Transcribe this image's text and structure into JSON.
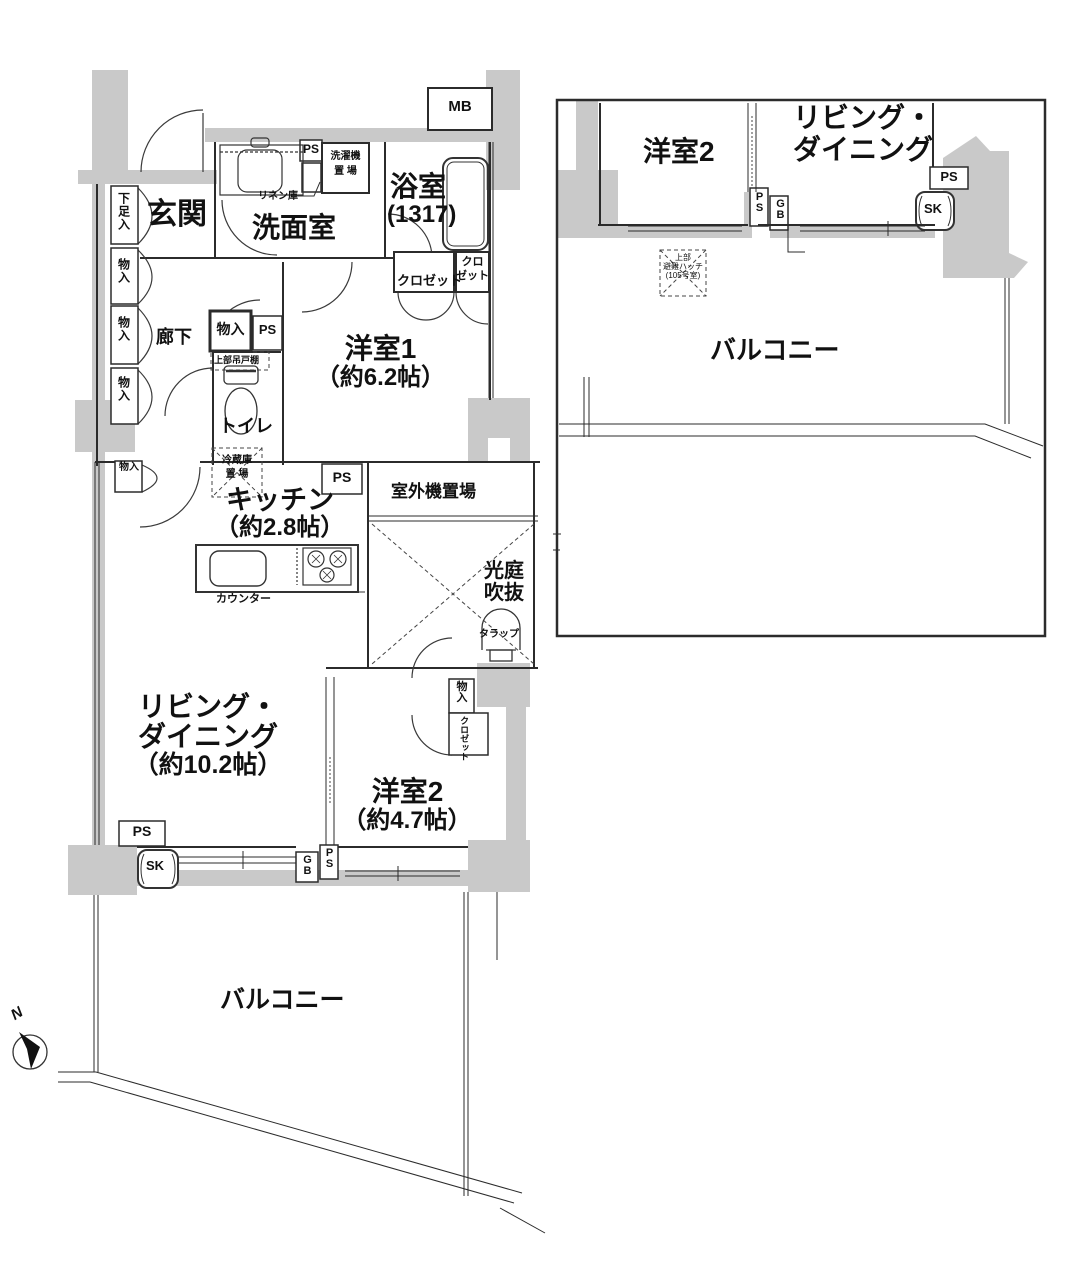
{
  "labels": {
    "genkan": "玄関",
    "rouka": "廊下",
    "senmen": "洗面室",
    "yokushitsu": "浴室",
    "yokushitsu_size": "(1317)",
    "yoshitsu1": "洋室1",
    "yoshitsu1_size": "（約6.2帖）",
    "kitchen": "キッチン",
    "kitchen_size": "（約2.8帖）",
    "living1": "リビング・",
    "living2": "ダイニング",
    "living_size": "（約10.2帖）",
    "yoshitsu2": "洋室2",
    "yoshitsu2_size": "（約4.7帖）",
    "toilet": "トイレ",
    "balcony": "バルコニー",
    "koutei1": "光庭",
    "koutei2": "吹抜",
    "shitsugaiki": "室外機置場",
    "counter": "カウンター",
    "tarappu": "タラップ",
    "joubu": "上部吊戸棚",
    "reizo1": "冷蔵庫",
    "reizo2": "置 場",
    "sentaku1": "洗濯機",
    "sentaku2": "置 場",
    "linen": "リネン庫",
    "closet": "クロゼット",
    "closet_s1": "クロ",
    "closet_s2": "ゼット",
    "closet_v": "クロゼット",
    "monoire": "物入",
    "kasoku": "下足入",
    "mb": "MB",
    "ps": "PS",
    "gb": "GB",
    "sk": "SK",
    "north": "N",
    "hatch1": "上部",
    "hatch2": "避難ハッチ",
    "hatch3": "(105号室)"
  },
  "inset": {
    "yoshitsu2": "洋室2",
    "living1": "リビング・",
    "living2": "ダイニング",
    "balcony": "バルコニー",
    "ps": "PS",
    "gb": "GB",
    "sk": "SK"
  },
  "colors": {
    "wall_gray": "#c9c9c9",
    "line": "#2b2b2b"
  }
}
